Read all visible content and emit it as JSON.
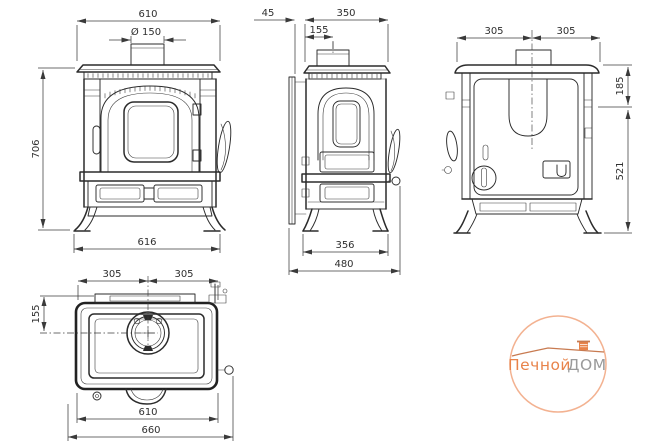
{
  "page": {
    "background_color": "#ffffff",
    "ink_color": "#2b2b2b"
  },
  "views": {
    "front": {
      "dim_top_width": "610",
      "dim_flue_diameter": "Ø 150",
      "dim_height": "706",
      "dim_feet_width": "616"
    },
    "side": {
      "dim_shield_gap": "45",
      "dim_top_depth": "350",
      "dim_flue_offset": "155",
      "dim_feet_depth": "356",
      "dim_total_depth": "480"
    },
    "back": {
      "dim_half_width_left": "305",
      "dim_half_width_right": "305",
      "dim_top_height": "185",
      "dim_body_height": "521"
    },
    "top": {
      "dim_half_width_left": "305",
      "dim_half_width_right": "305",
      "dim_flue_offset": "155",
      "dim_plate_width": "610",
      "dim_total_width": "660"
    }
  },
  "watermark": {
    "text_primary": "Печной",
    "text_secondary": "ДОМ",
    "circle_color": "#f3b291",
    "primary_color": "#e8834a",
    "secondary_color": "#9a9a9a",
    "roof_color": "#c87a50"
  }
}
